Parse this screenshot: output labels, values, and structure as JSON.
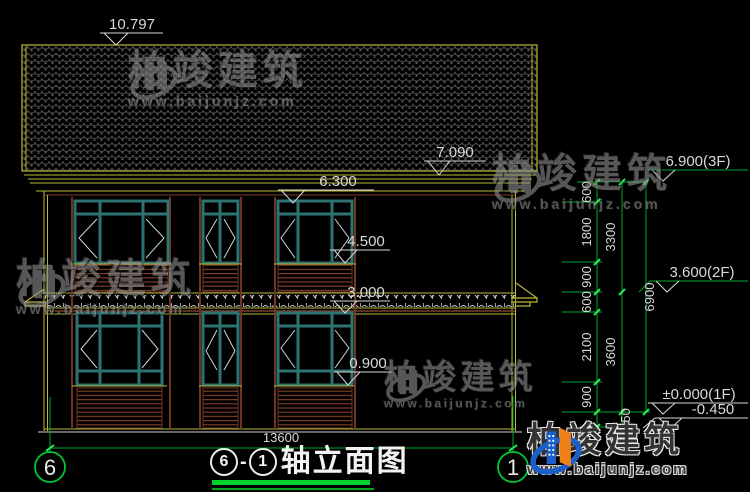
{
  "title": {
    "axis_start": "6",
    "separator": "-",
    "axis_end": "1",
    "label": "轴立面图"
  },
  "axes": {
    "left_bubble": "6",
    "right_bubble": "1"
  },
  "dims": {
    "total_width": "13600",
    "ridge": "10.797",
    "roof_edge": "7.090",
    "eave": "6.300",
    "sill_2f": "4.500",
    "head_1f": "3.000",
    "sill_1f": "0.900",
    "level_3f": "6.900(3F)",
    "level_2f": "3.600(2F)",
    "level_1f": "±0.000(1F)",
    "level_ground": "-0.450",
    "v600a": "600",
    "v1800": "1800",
    "v900a": "900",
    "v600b": "600",
    "v2100": "2100",
    "v900b": "900",
    "v450": "450",
    "v3300": "3300",
    "v3600": "3600",
    "v6900": "6900"
  },
  "watermark": {
    "brand": "柏竣建筑",
    "url": "www.baijunjz.com"
  },
  "colors": {
    "background": "#000000",
    "cad_yellow": "#b9b93a",
    "dim_green": "#00c832",
    "window_teal": "#2e7272",
    "trim_maroon": "#7a3d26",
    "text_light": "#d9d9d9",
    "logo_blue": "#1d5fc8",
    "logo_orange": "#ef7f17",
    "title_underline_green": "#00d22d"
  }
}
